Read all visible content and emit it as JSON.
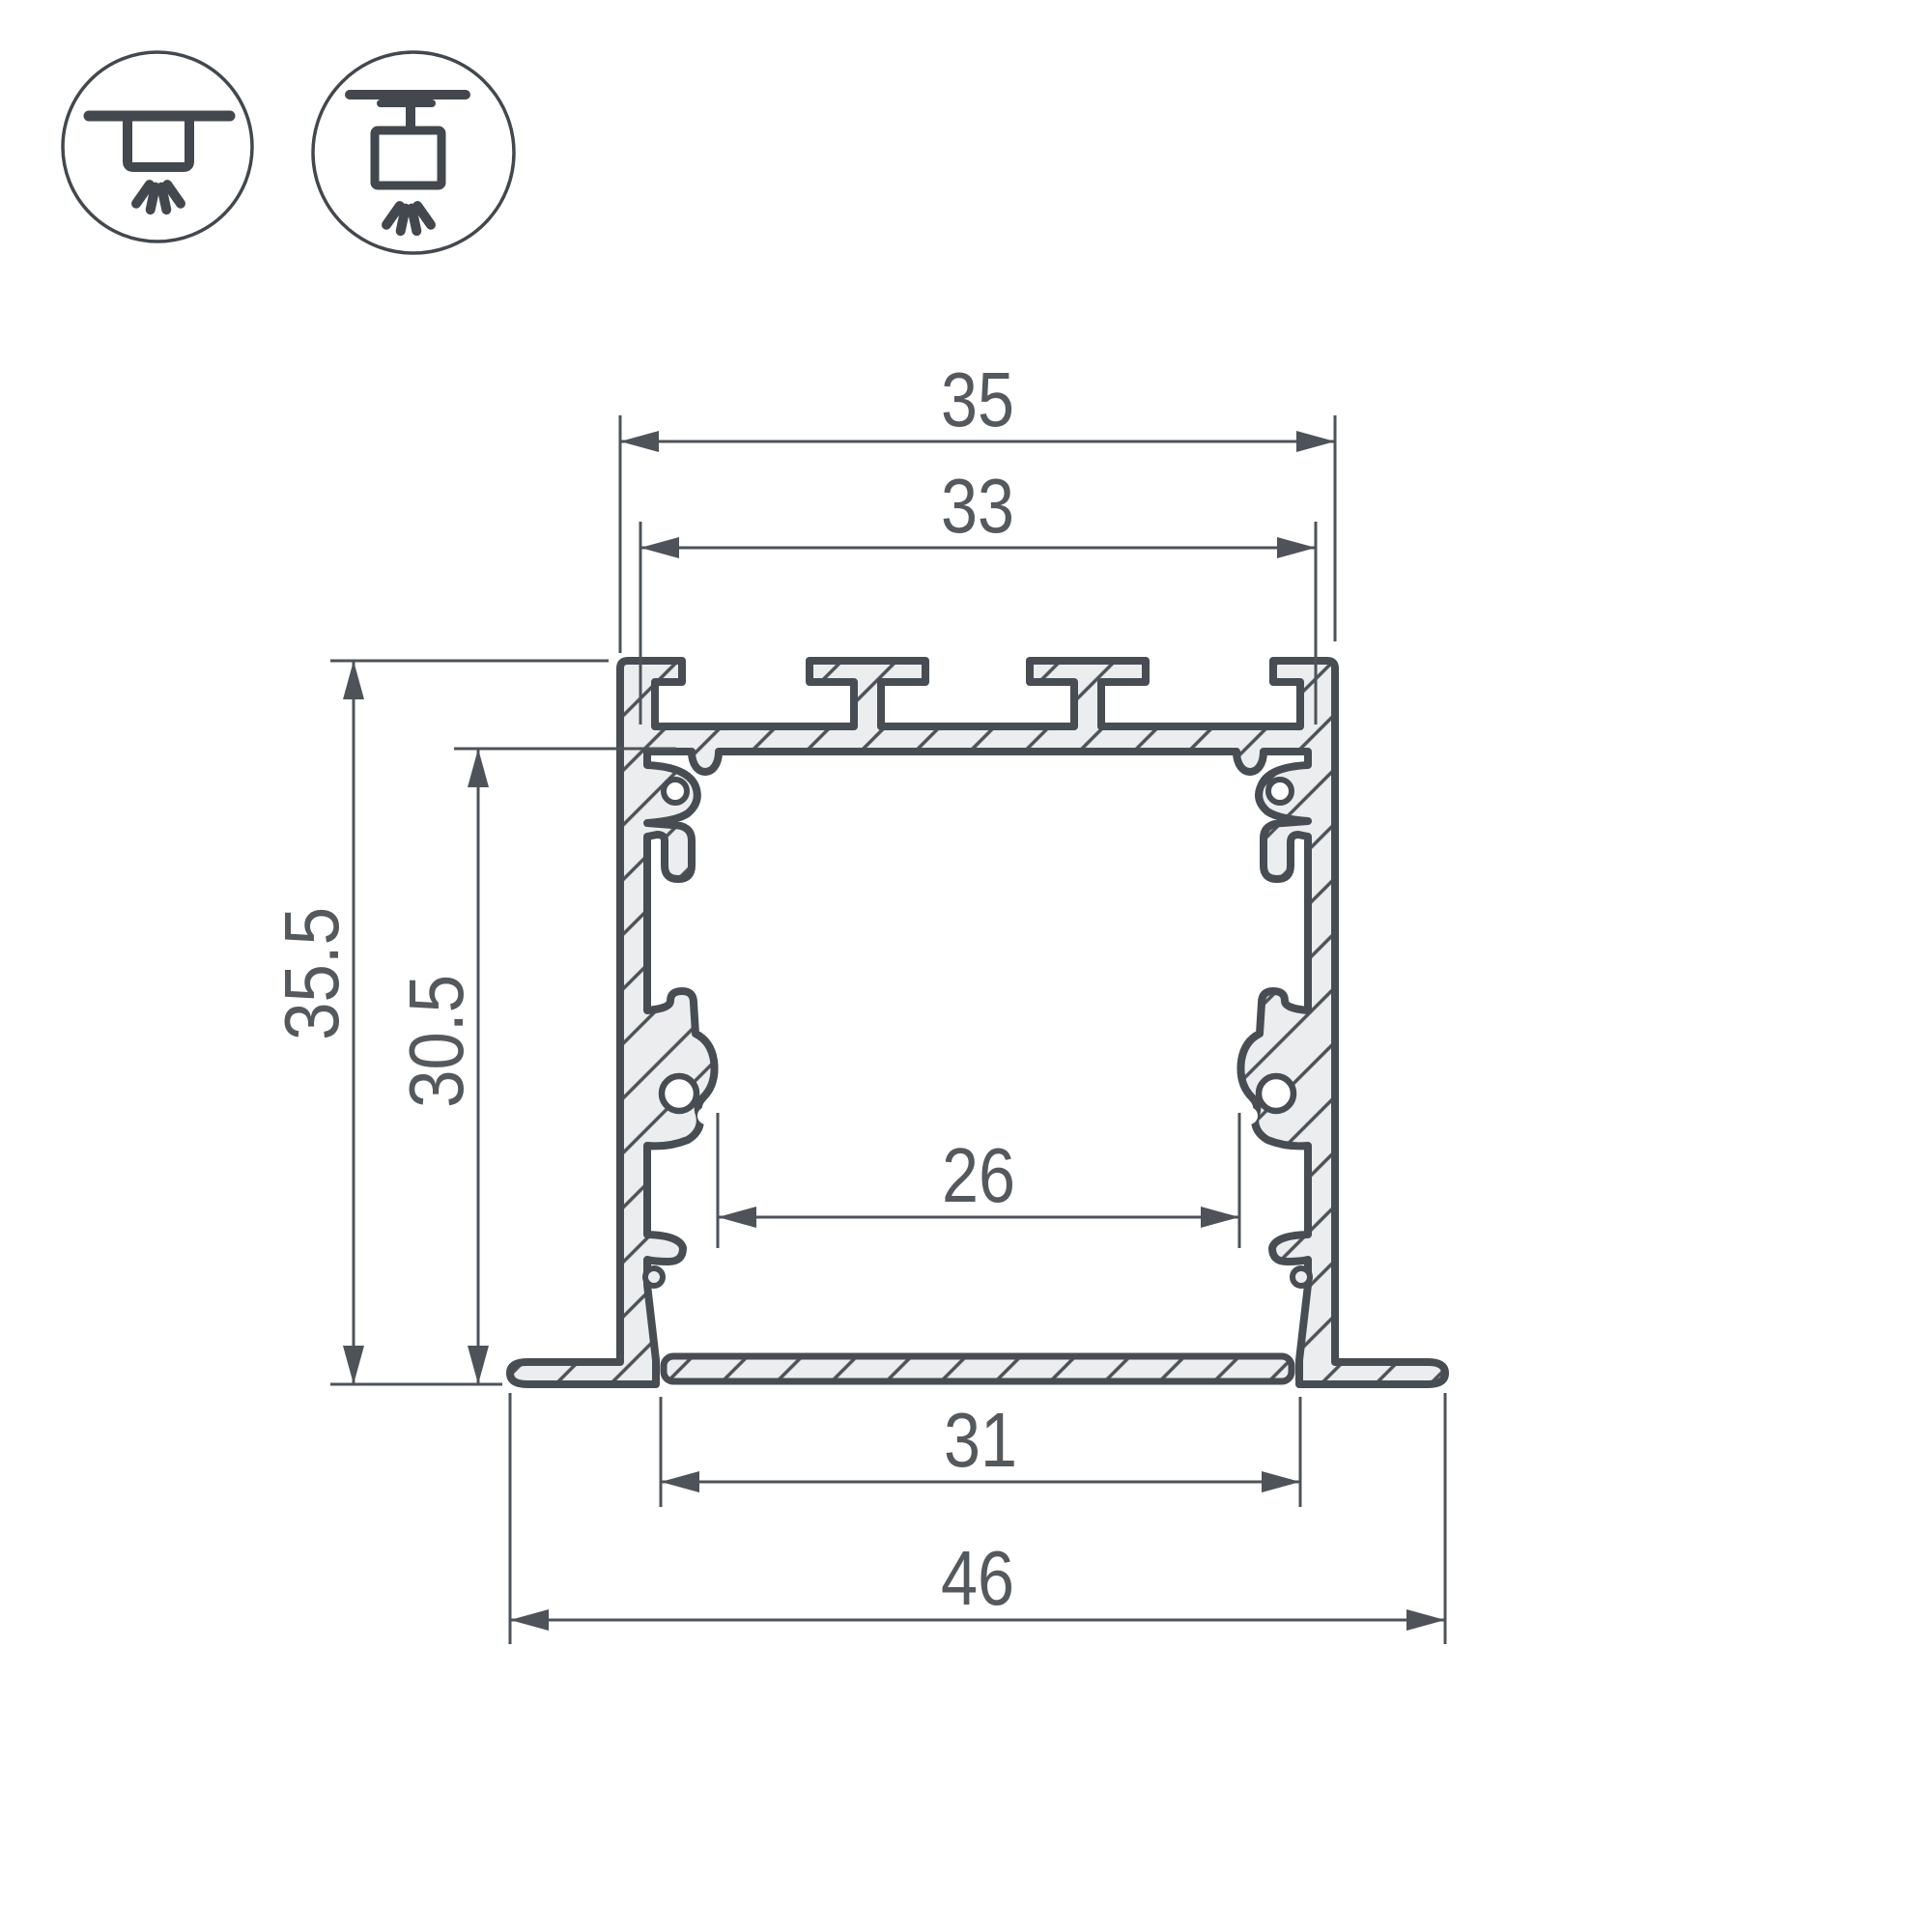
{
  "title": "Aluminium LED profile cross-section dimensional drawing",
  "mount_icons": [
    {
      "id": "recessed-mount",
      "label": "recessed ceiling mount"
    },
    {
      "id": "surface-mount",
      "label": "surface ceiling mount"
    }
  ],
  "dimensions": {
    "top_outer_width": "35",
    "top_inner_width": "33",
    "overall_height": "35.5",
    "inner_height": "30.5",
    "inner_width": "26",
    "recess_opening_width": "31",
    "flange_overall_width": "46"
  },
  "colors": {
    "background": "#ffffff",
    "outline": "#474d52",
    "dimension_line": "#4d5358",
    "material_fill": "#ecedee",
    "text": "#54595e"
  }
}
